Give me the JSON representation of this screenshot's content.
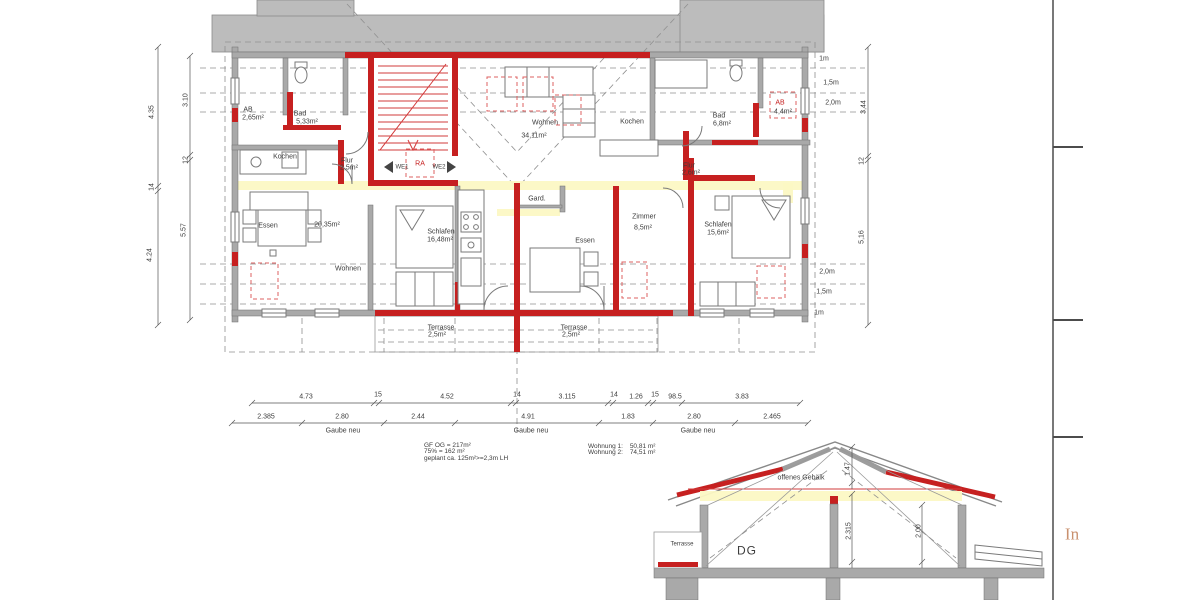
{
  "colors": {
    "wall_gray": "#a9a9a9",
    "band_gray": "#bcbcbc",
    "new_construction_red": "#c62020",
    "red_dashed": "#dd6060",
    "dash_gray": "#909090",
    "highlight_yellow": "#fcf8c4",
    "text": "#3c3c3c",
    "accent_orange": "#c9916f"
  },
  "annotation_block": {
    "line1": "GF OG = 217m²",
    "line2": "75% = 162 m²",
    "line3": "geplant ca. 125m²>=2,3m LH"
  },
  "apartments": [
    {
      "label": "Wohnung 1:",
      "area": "50,81 m²"
    },
    {
      "label": "Wohnung 2:",
      "area": "74,51 m²"
    }
  ],
  "section": {
    "title": "DG",
    "beam_label": "offenes Gebälk",
    "terrace_label": "Terrasse"
  },
  "side_text": "In",
  "labels": [
    {
      "n": "room-ab-left",
      "t": "AB",
      "x": 248,
      "y": 110
    },
    {
      "n": "room-ab-left-area",
      "t": "2,65m²",
      "x": 253,
      "y": 118
    },
    {
      "n": "room-bad-left",
      "t": "Bad",
      "x": 300,
      "y": 114
    },
    {
      "n": "room-bad-left-area",
      "t": "5,33m²",
      "x": 307,
      "y": 122
    },
    {
      "n": "room-kochen-left",
      "t": "Kochen",
      "x": 285,
      "y": 157
    },
    {
      "n": "room-flur-left",
      "t": "Flur",
      "x": 347,
      "y": 161
    },
    {
      "n": "room-flur-left-area",
      "t": "2,5m²",
      "x": 349,
      "y": 168
    },
    {
      "n": "label-we1",
      "t": "WE1",
      "x": 402,
      "y": 168,
      "c": "sm"
    },
    {
      "n": "label-ra",
      "t": "RA",
      "x": 420,
      "y": 164,
      "c": "red"
    },
    {
      "n": "label-we2",
      "t": "WE2",
      "x": 439,
      "y": 168,
      "c": "sm"
    },
    {
      "n": "room-essen-left",
      "t": "Essen",
      "x": 268,
      "y": 226
    },
    {
      "n": "area-wohnen-left",
      "t": "20,35m²",
      "x": 327,
      "y": 225
    },
    {
      "n": "room-wohnen-left",
      "t": "Wohnen",
      "x": 348,
      "y": 269
    },
    {
      "n": "room-schlafen-left",
      "t": "Schlafen",
      "x": 441,
      "y": 232
    },
    {
      "n": "room-schlafen-left-area",
      "t": "16,48m²",
      "x": 440,
      "y": 240
    },
    {
      "n": "room-terrasse-left",
      "t": "Terrasse",
      "x": 441,
      "y": 328
    },
    {
      "n": "room-terrasse-left-area",
      "t": "2,5m²",
      "x": 437,
      "y": 335
    },
    {
      "n": "room-wohnen-right",
      "t": "Wohnen",
      "x": 545,
      "y": 123
    },
    {
      "n": "room-wohnen-right-area",
      "t": "34,11m²",
      "x": 534,
      "y": 136
    },
    {
      "n": "room-kochen-right",
      "t": "Kochen",
      "x": 632,
      "y": 122
    },
    {
      "n": "room-bad-right",
      "t": "Bad",
      "x": 719,
      "y": 116
    },
    {
      "n": "room-bad-right-area",
      "t": "6,8m²",
      "x": 722,
      "y": 124
    },
    {
      "n": "room-ab-right",
      "t": "AB",
      "x": 780,
      "y": 103,
      "c": "red"
    },
    {
      "n": "room-ab-right-area",
      "t": "4,4m²",
      "x": 783,
      "y": 112
    },
    {
      "n": "room-flur-right",
      "t": "Flur",
      "x": 689,
      "y": 166
    },
    {
      "n": "room-flur-right-area",
      "t": "2,6m²",
      "x": 691,
      "y": 173
    },
    {
      "n": "room-zimmer",
      "t": "Zimmer",
      "x": 644,
      "y": 217
    },
    {
      "n": "room-zimmer-area",
      "t": "8,5m²",
      "x": 643,
      "y": 228
    },
    {
      "n": "room-essen-right",
      "t": "Essen",
      "x": 585,
      "y": 241
    },
    {
      "n": "room-gard",
      "t": "Gard.",
      "x": 537,
      "y": 199
    },
    {
      "n": "room-schlafen-right",
      "t": "Schlafen",
      "x": 718,
      "y": 225
    },
    {
      "n": "room-schlafen-right-area",
      "t": "15,6m²",
      "x": 718,
      "y": 233
    },
    {
      "n": "room-terrasse-right",
      "t": "Terrasse",
      "x": 574,
      "y": 328
    },
    {
      "n": "room-terrasse-right-area",
      "t": "2,5m²",
      "x": 571,
      "y": 335
    },
    {
      "n": "dim-left-435",
      "t": "4.35",
      "x": 152,
      "y": 112,
      "c": "rot"
    },
    {
      "n": "dim-left-14",
      "t": "14",
      "x": 152,
      "y": 187,
      "c": "rot"
    },
    {
      "n": "dim-left-424",
      "t": "4.24",
      "x": 150,
      "y": 255,
      "c": "rot"
    },
    {
      "n": "dim-left-310",
      "t": "3.10",
      "x": 186,
      "y": 100,
      "c": "rot"
    },
    {
      "n": "dim-left-12",
      "t": "12",
      "x": 186,
      "y": 160,
      "c": "rot"
    },
    {
      "n": "dim-left-557",
      "t": "5.57",
      "x": 184,
      "y": 230,
      "c": "rot"
    },
    {
      "n": "dim-right-1m-top",
      "t": "1m",
      "x": 824,
      "y": 59
    },
    {
      "n": "dim-right-15m-top",
      "t": "1,5m",
      "x": 831,
      "y": 83
    },
    {
      "n": "dim-right-20m-top",
      "t": "2,0m",
      "x": 833,
      "y": 103
    },
    {
      "n": "dim-right-344",
      "t": "3,44",
      "x": 864,
      "y": 107,
      "c": "rot"
    },
    {
      "n": "dim-right-12",
      "t": "12",
      "x": 862,
      "y": 161,
      "c": "rot"
    },
    {
      "n": "dim-right-516",
      "t": "5,16",
      "x": 862,
      "y": 237,
      "c": "rot"
    },
    {
      "n": "dim-right-20m-bot",
      "t": "2,0m",
      "x": 827,
      "y": 272
    },
    {
      "n": "dim-right-15m-bot",
      "t": "1,5m",
      "x": 824,
      "y": 292
    },
    {
      "n": "dim-right-1m-bot",
      "t": "1m",
      "x": 819,
      "y": 313
    },
    {
      "n": "dim-bottom1-473",
      "t": "4.73",
      "x": 306,
      "y": 397
    },
    {
      "n": "dim-bottom1-15a",
      "t": "15",
      "x": 378,
      "y": 395
    },
    {
      "n": "dim-bottom1-452",
      "t": "4.52",
      "x": 447,
      "y": 397
    },
    {
      "n": "dim-bottom1-14a",
      "t": "14",
      "x": 517,
      "y": 395
    },
    {
      "n": "dim-bottom1-3115",
      "t": "3.115",
      "x": 567,
      "y": 397
    },
    {
      "n": "dim-bottom1-14b",
      "t": "14",
      "x": 614,
      "y": 395
    },
    {
      "n": "dim-bottom1-126",
      "t": "1.26",
      "x": 636,
      "y": 397
    },
    {
      "n": "dim-bottom1-15b",
      "t": "15",
      "x": 655,
      "y": 395
    },
    {
      "n": "dim-bottom1-985",
      "t": "98.5",
      "x": 675,
      "y": 397
    },
    {
      "n": "dim-bottom1-383",
      "t": "3.83",
      "x": 742,
      "y": 397
    },
    {
      "n": "dim-bottom2-2385",
      "t": "2.385",
      "x": 266,
      "y": 417
    },
    {
      "n": "dim-bottom2-280a",
      "t": "2.80",
      "x": 342,
      "y": 417
    },
    {
      "n": "dim-bottom2-244",
      "t": "2.44",
      "x": 418,
      "y": 417
    },
    {
      "n": "dim-bottom2-491",
      "t": "4.91",
      "x": 528,
      "y": 417
    },
    {
      "n": "dim-bottom2-183",
      "t": "1.83",
      "x": 628,
      "y": 417
    },
    {
      "n": "dim-bottom2-280b",
      "t": "2.80",
      "x": 694,
      "y": 417
    },
    {
      "n": "dim-bottom2-2465",
      "t": "2.465",
      "x": 772,
      "y": 417
    },
    {
      "n": "gaube-neu-1",
      "t": "Gaube neu",
      "x": 343,
      "y": 431
    },
    {
      "n": "gaube-neu-2",
      "t": "Gaube neu",
      "x": 531,
      "y": 431
    },
    {
      "n": "gaube-neu-3",
      "t": "Gaube neu",
      "x": 698,
      "y": 431
    },
    {
      "n": "section-beam-label",
      "t": "offenes Gebälk",
      "x": 801,
      "y": 478
    },
    {
      "n": "section-title",
      "t": "DG",
      "x": 747,
      "y": 551,
      "c": "big"
    },
    {
      "n": "section-terrasse",
      "t": "Terrasse",
      "x": 682,
      "y": 545,
      "c": "sm"
    },
    {
      "n": "section-dim-147",
      "t": "1.47",
      "x": 848,
      "y": 469,
      "c": "rot"
    },
    {
      "n": "section-dim-2315",
      "t": "2.315",
      "x": 849,
      "y": 531,
      "c": "rot"
    },
    {
      "n": "section-dim-200",
      "t": "2.00",
      "x": 919,
      "y": 531,
      "c": "rot"
    },
    {
      "n": "sheet-side-text",
      "t": "In",
      "x": 1072,
      "y": 534,
      "c": "orange"
    }
  ]
}
